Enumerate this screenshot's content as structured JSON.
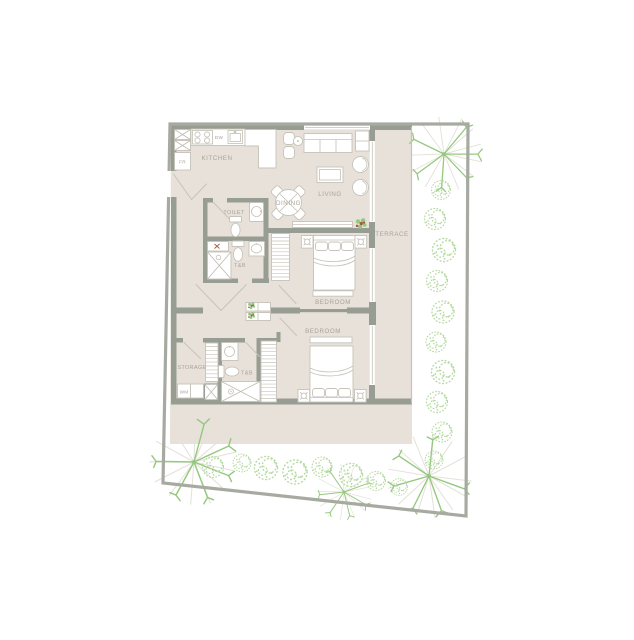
{
  "labels": {
    "kitchen": "KITCHEN",
    "dishwasher": "DW",
    "fridge": "FR",
    "living": "LIVING",
    "dining": "DINING",
    "toilet": "TOILET",
    "bath_upper": "T&B",
    "terrace": "TERRACE",
    "bedroom_upper": "BEDROOM",
    "bedroom_lower": "BEDROOM",
    "storage": "STORAGE",
    "bath_lower": "T&B",
    "washing_machine": "WM"
  },
  "colors": {
    "background": "#ffffff",
    "floor": "#e8e1da",
    "wall": "#989d93",
    "lot_border": "#a7aaa0",
    "furn_line": "#c6c3b9",
    "label": "#a8a39b",
    "shrub": "#b7daa3",
    "fern_green": "#94c87f",
    "fern_gray": "#e4e1d8",
    "pot": "#9c6140",
    "glass": "#c3c1b8"
  }
}
